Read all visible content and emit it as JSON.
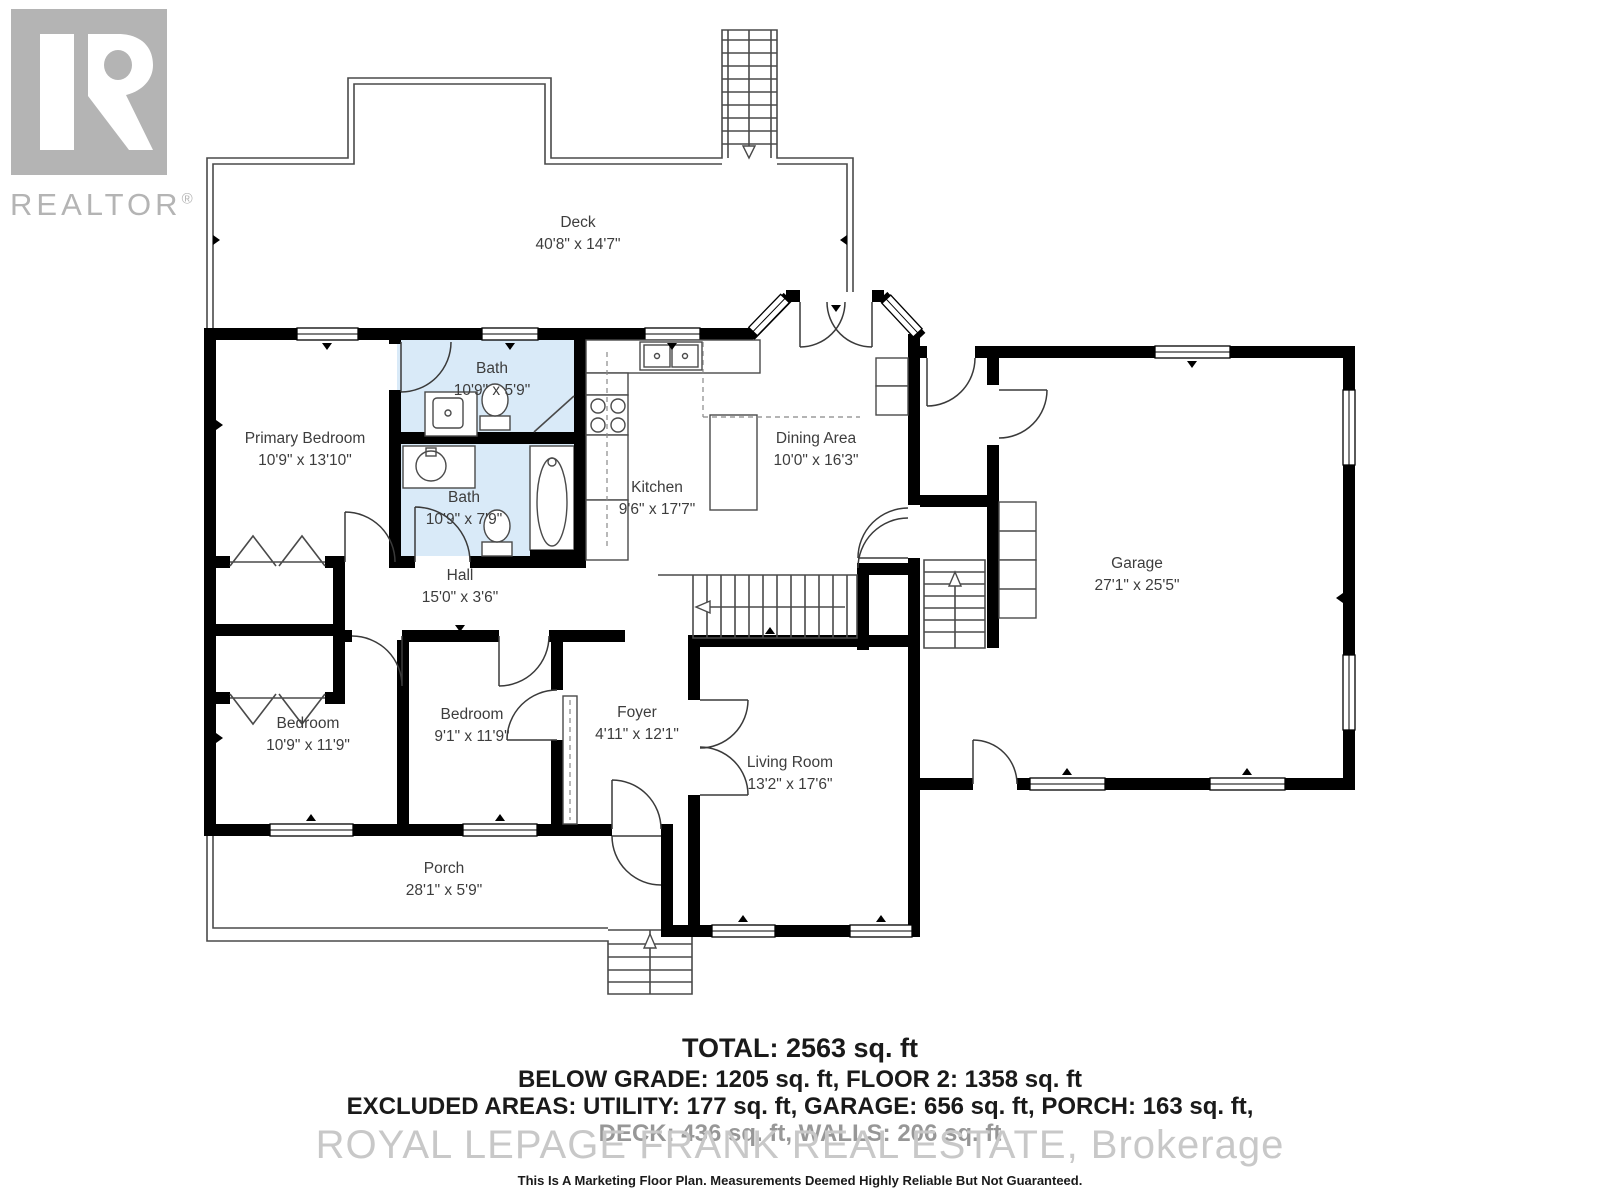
{
  "branding": {
    "logo_letter": "R",
    "logo_text": "REALTOR",
    "logo_reg": "®"
  },
  "rooms": [
    {
      "name": "Deck",
      "dims": "40'8\" x 14'7\""
    },
    {
      "name": "Primary Bedroom",
      "dims": "10'9\" x 13'10\""
    },
    {
      "name": "Bath",
      "dims": "10'9\" x 5'9\""
    },
    {
      "name": "Bath",
      "dims": "10'9\" x 7'9\""
    },
    {
      "name": "Kitchen",
      "dims": "9'6\" x 17'7\""
    },
    {
      "name": "Dining Area",
      "dims": "10'0\" x 16'3\""
    },
    {
      "name": "Garage",
      "dims": "27'1\" x 25'5\""
    },
    {
      "name": "Hall",
      "dims": "15'0\" x 3'6\""
    },
    {
      "name": "Bedroom",
      "dims": "10'9\" x 11'9\""
    },
    {
      "name": "Bedroom",
      "dims": "9'1\" x 11'9\""
    },
    {
      "name": "Foyer",
      "dims": "4'11\" x 12'1\""
    },
    {
      "name": "Living Room",
      "dims": "13'2\" x 17'6\""
    },
    {
      "name": "Porch",
      "dims": "28'1\" x 5'9\""
    }
  ],
  "summary": {
    "total": "TOTAL: 2563 sq. ft",
    "line2": "BELOW GRADE: 1205 sq. ft, FLOOR 2: 1358 sq. ft",
    "line3": "EXCLUDED AREAS: UTILITY: 177 sq. ft, GARAGE: 656 sq. ft, PORCH: 163 sq. ft,",
    "line4": "DECK: 436 sq. ft, WALLS: 206 sq. ft"
  },
  "watermark": "ROYAL LEPAGE FRANK REAL ESTATE, Brokerage",
  "disclaimer": "This Is A Marketing Floor Plan. Measurements Deemed Highly Reliable But Not Guaranteed.",
  "colors": {
    "wall": "#000000",
    "bath": "#d9eaf8",
    "line": "#4a4a4a",
    "label": "#3d3d3d",
    "watermark": "#c8c8c8",
    "logo": "#b4b4b4",
    "text": "#1a1a1a"
  }
}
